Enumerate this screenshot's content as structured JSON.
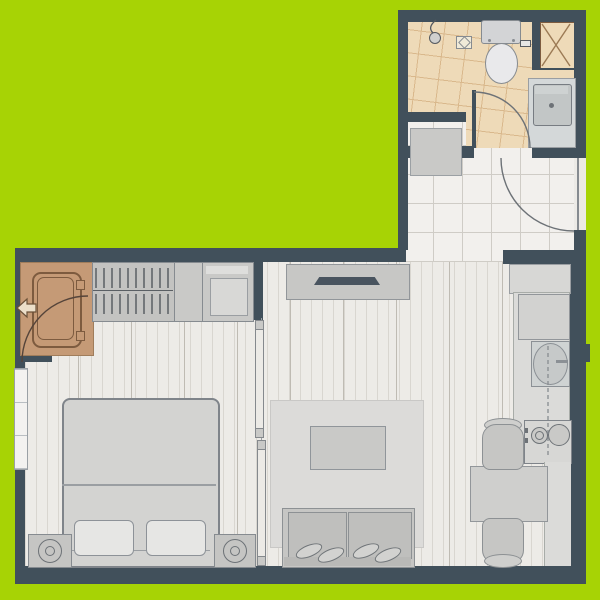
{
  "title": "studio-apartment-floor-plan",
  "theme": {
    "bg": "#a7d305",
    "wall": "#41505b",
    "plank": "#edebe7",
    "plank_line": "#d9d6d0",
    "plank_line2": "#bfbbb3",
    "tile": "#f2f0ed",
    "tile_line": "#cfccc6",
    "bath": "#eedab8",
    "bath_line": "#d9b88c",
    "wood": "#c59a76",
    "wood_line": "#7d5b3f",
    "fur": "#c9c9c7",
    "fur_dark": "#868b90",
    "fur_light": "#dededc",
    "fixture": "#e9e9eb",
    "counter": "#dbdbd9",
    "rug": "#dcdbd9",
    "basin": "#c2c6c6",
    "panel": "#eceae6",
    "arc": "#6d7277"
  },
  "rooms": {
    "bathroom": {
      "label": "bathroom",
      "items": [
        "toilet",
        "shower-head",
        "floor-drain",
        "paper-holder",
        "washbasin-counter",
        "service-shaft",
        "swing-door"
      ]
    },
    "entry_hall": {
      "label": "entry-hall",
      "items": [
        "entrance-door",
        "storage-cabinet",
        "tiled-floor"
      ]
    },
    "bedroom": {
      "label": "bedroom",
      "items": [
        "wooden-wardrobe",
        "entry-arrow",
        "hanging-rail-closet",
        "shelf-cabinet",
        "double-bed",
        "pillows",
        "nightstand-with-lamp-left",
        "nightstand-with-lamp-right",
        "window"
      ]
    },
    "living_room": {
      "label": "living-room",
      "items": [
        "tv-console",
        "wall-tv",
        "area-rug",
        "coffee-table",
        "two-seat-sofa",
        "cushions",
        "sliding-partition"
      ]
    },
    "kitchen_dining": {
      "label": "kitchen-dining",
      "items": [
        "upper-cabinet",
        "refrigerator-counter",
        "kitchen-sink",
        "two-burner-stove",
        "lower-counter",
        "dining-table",
        "chair-top",
        "chair-bottom"
      ]
    }
  }
}
